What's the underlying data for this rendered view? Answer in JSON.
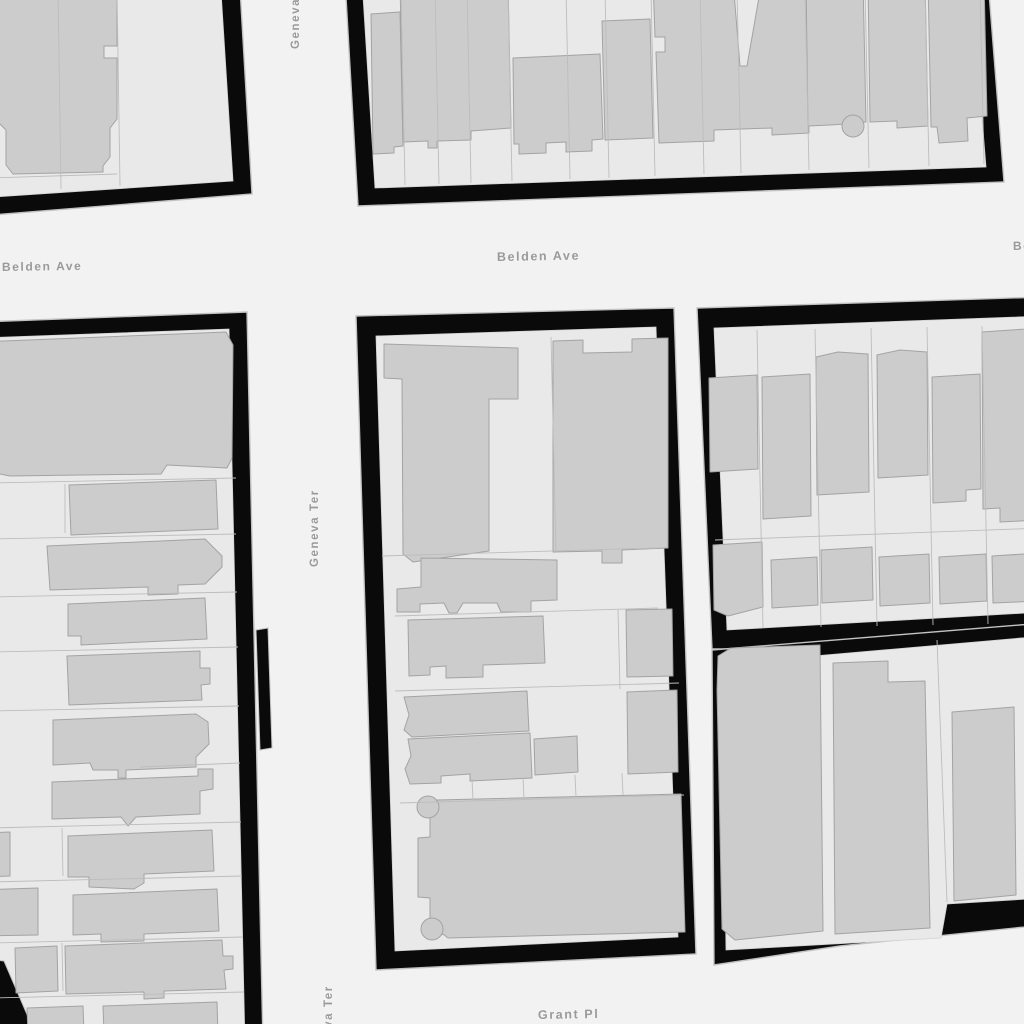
{
  "map": {
    "type": "parcel-basemap",
    "colors": {
      "street": "#f2f2f2",
      "block_border": "#0a0a0a",
      "block_edge_line": "#c2c2c2",
      "parcel_fill": "#e9e9e9",
      "lot_line": "#bdbdbd",
      "building_fill": "#cccccc",
      "building_stroke": "#a3a3a3",
      "label_text": "#9a9a9a"
    },
    "street_labels": [
      {
        "id": "belden-ave-left",
        "text": "Belden Ave",
        "x": 2,
        "y": 271,
        "rotate": -0.8,
        "size": 12
      },
      {
        "id": "belden-ave-center",
        "text": "Belden Ave",
        "x": 497,
        "y": 261,
        "rotate": -1,
        "size": 12.5
      },
      {
        "id": "belden-ave-right",
        "text": "Belden Ave",
        "x": 1013,
        "y": 250,
        "rotate": -1,
        "size": 12
      },
      {
        "id": "geneva-ter-top",
        "text": "Geneva Ter",
        "x": 299,
        "y": 49,
        "rotate": -90,
        "size": 11.5
      },
      {
        "id": "geneva-ter-mid",
        "text": "Geneva Ter",
        "x": 318,
        "y": 567,
        "rotate": -90,
        "size": 11.5
      },
      {
        "id": "geneva-ter-bottom",
        "text": "Geneva Ter",
        "x": 332,
        "y": 1063,
        "rotate": -90,
        "size": 11.5
      },
      {
        "id": "grant-pl",
        "text": "Grant Pl",
        "x": 538,
        "y": 1019,
        "rotate": -1,
        "size": 12.5
      }
    ],
    "blocks": [
      {
        "id": "nw",
        "outer": "-20,-20 240,-12 252,194 -20,216",
        "inner": "-20,-20 221,-9 233,181 -20,198"
      },
      {
        "id": "ne",
        "outer": "345,-20 988,-20 1004,182 358,206",
        "inner": "362,-20 971,-20 986,167 375,188"
      },
      {
        "id": "w",
        "outer": "-20,322 247,312 263,1044 -20,1044",
        "inner": "-20,338 229,329 245,1044 -20,1044"
      },
      {
        "id": "center",
        "outer": "356,316 674,308 696,954 376,970",
        "inner": "376,336 656,327 678,937 395,951"
      },
      {
        "id": "e-upper",
        "outer": "697,308 1044,297 1044,649 712,649",
        "inner": "714,328 1044,316 1044,612 727,630"
      },
      {
        "id": "e-lower",
        "outer": "712,650 1044,623 1044,925 840,946 714,965",
        "inner": "722,664 1044,636 1044,898 947,904 941,938 726,950"
      }
    ],
    "extras": [
      {
        "id": "alley-mark",
        "points": "256,630 268,628 272,748 260,750"
      },
      {
        "id": "sw-corner-wedge",
        "points": "-20,958 4,961 38,1040 -20,1040"
      }
    ],
    "buildings": [
      {
        "block": "nw",
        "points": "-20,-20 117,-20 117,46 104,46 104,58 117,58 117,119 110,128 110,157 103,166 103,172 13,174 6,165 6,130 0,124 -20,124"
      },
      {
        "block": "ne",
        "points": "371,14 400,12 403,146 394,147 394,153 373,154"
      },
      {
        "block": "ne",
        "points": "400,-20 508,-20 511,128 471,131 471,140 437,141 437,148 428,148 428,141 403,142"
      },
      {
        "block": "ne",
        "points": "513,58 600,54 603,139 592,140 592,151 566,152 566,142 546,143 546,153 519,154 519,144 514,144"
      },
      {
        "block": "ne",
        "points": "602,21 650,19 653,138 605,140"
      },
      {
        "block": "ne",
        "points": "653,-20 733,-20 740,66 747,66 762,-20 806,-20 809,133 772,135 772,128 714,130 714,141 659,143 656,52 665,52 665,37 655,37"
      },
      {
        "block": "ne",
        "points": "806,-20 863,-20 866,122 845,124 830,125 808,126"
      },
      {
        "block": "ne",
        "points": "868,-20 925,-20 928,126 897,128 897,121 870,122"
      },
      {
        "block": "ne",
        "points": "928,-20 984,-20 987,116 967,118 968,141 939,143 937,127 931,127"
      },
      {
        "block": "w",
        "points": "-20,342 226,332 233,345 232,458 227,468 167,465 161,474 10,476 -20,470"
      },
      {
        "block": "w",
        "points": "69,485 216,480 218,529 71,535"
      },
      {
        "block": "w",
        "points": "47,546 205,539 222,556 222,567 205,584 178,585 178,594 148,595 148,587 50,590"
      },
      {
        "block": "w",
        "points": "68,604 205,598 207,639 81,645 81,636 68,636"
      },
      {
        "block": "w",
        "points": "67,656 200,651 200,668 210,668 210,684 201,685 202,700 69,705"
      },
      {
        "block": "w",
        "points": "53,720 196,714 208,722 209,744 196,757 196,767 126,770 126,778 118,778 118,770 93,770 90,763 53,765"
      },
      {
        "block": "w",
        "points": "52,782 198,776 198,769 213,769 213,789 200,791 200,814 136,817 128,826 121,817 52,819"
      },
      {
        "block": "w",
        "points": "68,836 212,830 214,871 144,874 144,883 134,889 89,887 89,877 68,877"
      },
      {
        "block": "w",
        "points": "-20,833 10,832 10,876 -20,877"
      },
      {
        "block": "w",
        "points": "73,895 217,889 219,931 144,934 144,941 101,942 101,934 73,935"
      },
      {
        "block": "w",
        "points": "-20,890 38,888 38,935 -20,936"
      },
      {
        "block": "w",
        "points": "15,948 57,946 58,991 16,993"
      },
      {
        "block": "w",
        "points": "65,946 222,940 223,956 233,956 233,969 224,970 226,989 164,991 164,998 144,999 144,992 66,994"
      },
      {
        "block": "w",
        "points": "27,1008 83,1006 84,1034 28,1034"
      },
      {
        "block": "w",
        "points": "103,1006 217,1002 218,1034 104,1034"
      },
      {
        "block": "center",
        "points": "384,344 518,348 518,399 489,399 489,551 413,562 403,554 402,379 384,378"
      },
      {
        "block": "center",
        "points": "553,341 583,340 583,353 632,352 632,339 668,338 668,548 622,550 622,563 602,563 602,551 553,552"
      },
      {
        "block": "center",
        "points": "421,558 557,560 557,600 531,601 531,612 501,612 497,603 463,603 457,613 449,613 444,603 420,604 420,612 397,612 397,589 421,587"
      },
      {
        "block": "center",
        "points": "408,620 543,616 545,663 483,665 483,677 446,678 446,666 430,667 430,675 409,676"
      },
      {
        "block": "center",
        "points": "626,610 672,609 673,676 627,677"
      },
      {
        "block": "center",
        "points": "404,697 527,691 529,731 412,737 404,730 409,715"
      },
      {
        "block": "center",
        "points": "408,739 530,733 532,778 470,781 470,774 441,776 441,783 410,784 405,769 411,756"
      },
      {
        "block": "center",
        "points": "534,739 577,736 578,772 535,775"
      },
      {
        "block": "center",
        "points": "627,692 677,690 678,772 628,774"
      },
      {
        "block": "center",
        "points": "437,800 681,794 685,932 448,938 443,934 436,938 430,921 430,898 418,897 418,838 430,837 430,818 421,810"
      },
      {
        "block": "e-upper",
        "points": "709,378 757,375 758,469 710,472"
      },
      {
        "block": "e-upper",
        "points": "762,377 810,374 811,516 763,519"
      },
      {
        "block": "e-upper",
        "points": "816,357 838,352 868,354 869,492 817,495"
      },
      {
        "block": "e-upper",
        "points": "877,355 900,350 927,352 928,475 878,478"
      },
      {
        "block": "e-upper",
        "points": "932,377 980,374 981,489 966,490 966,501 933,503"
      },
      {
        "block": "e-upper",
        "points": "982,332 1040,328 1040,520 1000,522 1000,508 983,509"
      },
      {
        "block": "e-upper",
        "points": "713,545 762,542 763,607 728,616 714,610"
      },
      {
        "block": "e-upper",
        "points": "771,560 817,557 818,605 772,608"
      },
      {
        "block": "e-upper",
        "points": "821,550 872,547 873,600 822,603"
      },
      {
        "block": "e-upper",
        "points": "879,557 929,554 930,603 880,606"
      },
      {
        "block": "e-upper",
        "points": "939,557 986,554 987,601 940,604"
      },
      {
        "block": "e-upper",
        "points": "992,556 1040,553 1040,601 993,603"
      },
      {
        "block": "e-lower",
        "points": "718,656 731,648 820,645 823,931 735,940 722,929 717,690"
      },
      {
        "block": "e-lower",
        "points": "833,663 888,661 888,682 925,681 930,928 835,934"
      },
      {
        "block": "e-lower",
        "points": "952,712 1014,707 1016,895 954,901"
      }
    ],
    "building_knobs": [
      {
        "cx": 853,
        "cy": 126,
        "r": 11
      },
      {
        "cx": 428,
        "cy": 807,
        "r": 11
      },
      {
        "cx": 432,
        "cy": 929,
        "r": 11
      }
    ],
    "lot_lines": [
      {
        "block": "nw",
        "points": "58,-10 61,189"
      },
      {
        "block": "nw",
        "points": "117,-10 120,186"
      },
      {
        "block": "nw",
        "points": "-10,178 117,174"
      },
      {
        "block": "ne",
        "points": "401,-10 405,185"
      },
      {
        "block": "ne",
        "points": "435,-10 439,184"
      },
      {
        "block": "ne",
        "points": "467,-10 471,183"
      },
      {
        "block": "ne",
        "points": "508,-10 512,181"
      },
      {
        "block": "ne",
        "points": "566,-10 570,179"
      },
      {
        "block": "ne",
        "points": "605,-10 609,178"
      },
      {
        "block": "ne",
        "points": "651,-10 655,176"
      },
      {
        "block": "ne",
        "points": "700,-10 704,174"
      },
      {
        "block": "ne",
        "points": "737,-10 741,173"
      },
      {
        "block": "ne",
        "points": "805,-10 809,170"
      },
      {
        "block": "ne",
        "points": "865,-10 869,168"
      },
      {
        "block": "ne",
        "points": "925,-10 929,166"
      },
      {
        "block": "ne",
        "points": "980,-10 984,164"
      },
      {
        "block": "w",
        "points": "-10,483 236,478"
      },
      {
        "block": "w",
        "points": "-10,539 236,534"
      },
      {
        "block": "w",
        "points": "-10,597 237,592"
      },
      {
        "block": "w",
        "points": "-10,652 238,647"
      },
      {
        "block": "w",
        "points": "-10,711 239,706"
      },
      {
        "block": "w",
        "points": "140,767 240,763"
      },
      {
        "block": "w",
        "points": "-10,828 241,822"
      },
      {
        "block": "w",
        "points": "-10,882 242,876"
      },
      {
        "block": "w",
        "points": "-10,943 243,937"
      },
      {
        "block": "w",
        "points": "-10,998 244,992"
      },
      {
        "block": "w",
        "points": "65,484 65,533"
      },
      {
        "block": "w",
        "points": "62,828 63,876"
      },
      {
        "block": "w",
        "points": "62,943 63,991"
      },
      {
        "block": "center",
        "points": "551,337 556,552"
      },
      {
        "block": "center",
        "points": "382,556 657,548"
      },
      {
        "block": "center",
        "points": "395,616 658,608"
      },
      {
        "block": "center",
        "points": "395,691 679,683"
      },
      {
        "block": "center",
        "points": "400,803 684,795"
      },
      {
        "block": "center",
        "points": "472,779 473,800"
      },
      {
        "block": "center",
        "points": "523,777 524,799"
      },
      {
        "block": "center",
        "points": "575,775 576,797"
      },
      {
        "block": "center",
        "points": "622,773 623,795"
      },
      {
        "block": "center",
        "points": "618,610 620,689"
      },
      {
        "block": "e-upper",
        "points": "757,330 763,628"
      },
      {
        "block": "e-upper",
        "points": "815,329 821,627"
      },
      {
        "block": "e-upper",
        "points": "871,328 877,626"
      },
      {
        "block": "e-upper",
        "points": "927,327 933,625"
      },
      {
        "block": "e-upper",
        "points": "982,326 988,624"
      },
      {
        "block": "e-upper",
        "points": "715,540 1044,528"
      },
      {
        "block": "e-lower",
        "points": "937,640 947,902"
      }
    ]
  }
}
